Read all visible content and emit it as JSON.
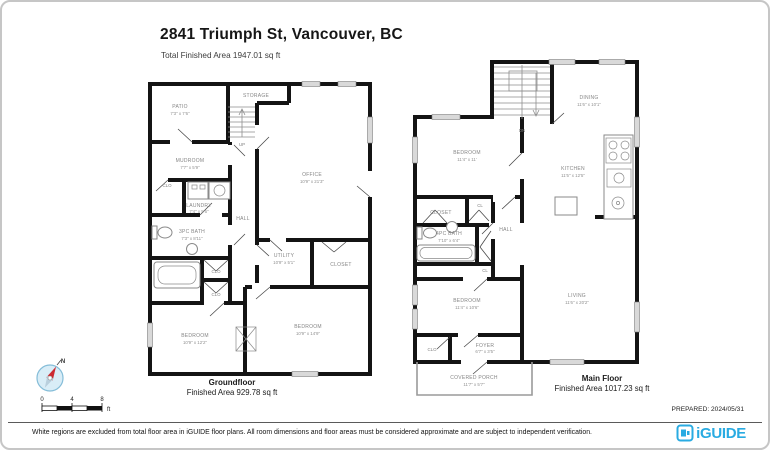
{
  "page": {
    "title": "2841 Triumph St, Vancouver, BC",
    "subtitle": "Total Finished Area 1947.01 sq ft",
    "prepared": "PREPARED: 2024/05/31",
    "disclaimer": "White regions are excluded from total floor area in iGUIDE floor plans. All room dimensions and floor areas must be considered approximate and are subject to independent verification.",
    "brand": "iGUIDE",
    "compass_n": "N",
    "scale": {
      "t0": "0",
      "t4": "4",
      "t8": "8",
      "unit": "ft"
    },
    "accent_blue": "#29abe2",
    "wall_color": "#141414"
  },
  "groundfloor": {
    "name": "Groundfloor",
    "area": "Finished Area 929.78 sq ft",
    "rooms": {
      "patio": {
        "label": "PATIO",
        "dims": "7'3\" x 7'6\""
      },
      "storage": {
        "label": "STORAGE"
      },
      "up": "UP",
      "mudroom": {
        "label": "MUDROOM",
        "dims": "7'7\" x 5'9\""
      },
      "clo_upper": "CLO",
      "laundry": {
        "label": "LAUNDRY",
        "dims": "7'4\" x 5'5\""
      },
      "bath": {
        "label": "3PC BATH",
        "dims": "7'3\" x 8'11\""
      },
      "hall": "HALL",
      "office": {
        "label": "OFFICE",
        "dims": "10'9\" x 21'3\""
      },
      "utility": {
        "label": "UTILITY",
        "dims": "10'9\" x 5'1\""
      },
      "closet": "CLOSET",
      "clo_mid": "CLO",
      "clo_lower": "CLO",
      "bedroom_left": {
        "label": "BEDROOM",
        "dims": "10'9\" x 12'2\""
      },
      "bedroom_right": {
        "label": "BEDROOM",
        "dims": "10'9\" x 14'9\""
      }
    }
  },
  "mainfloor": {
    "name": "Main Floor",
    "area": "Finished Area 1017.23 sq ft",
    "rooms": {
      "dn": "DN",
      "dining": {
        "label": "DINING",
        "dims": "11'6\" x 10'1\""
      },
      "bedroom_upper": {
        "label": "BEDROOM",
        "dims": "11'4\" x 11'"
      },
      "kitchen": {
        "label": "KITCHEN",
        "dims": "11'5\" x 12'5\""
      },
      "closet": "CLOSET",
      "cl_upper": "CL",
      "bath": {
        "label": "4PC BATH",
        "dims": "7'10\" x 6'4\""
      },
      "hall": "HALL",
      "cl_lower": "CL",
      "bedroom_lower": {
        "label": "BEDROOM",
        "dims": "11'4\" x 10'6\""
      },
      "living": {
        "label": "LIVING",
        "dims": "11'6\" x 20'2\""
      },
      "clo": "CLO",
      "foyer": {
        "label": "FOYER",
        "dims": "6'7\" x 3'5\""
      },
      "porch": {
        "label": "COVERED PORCH",
        "dims": "11'7\" x 5'7\""
      }
    }
  }
}
